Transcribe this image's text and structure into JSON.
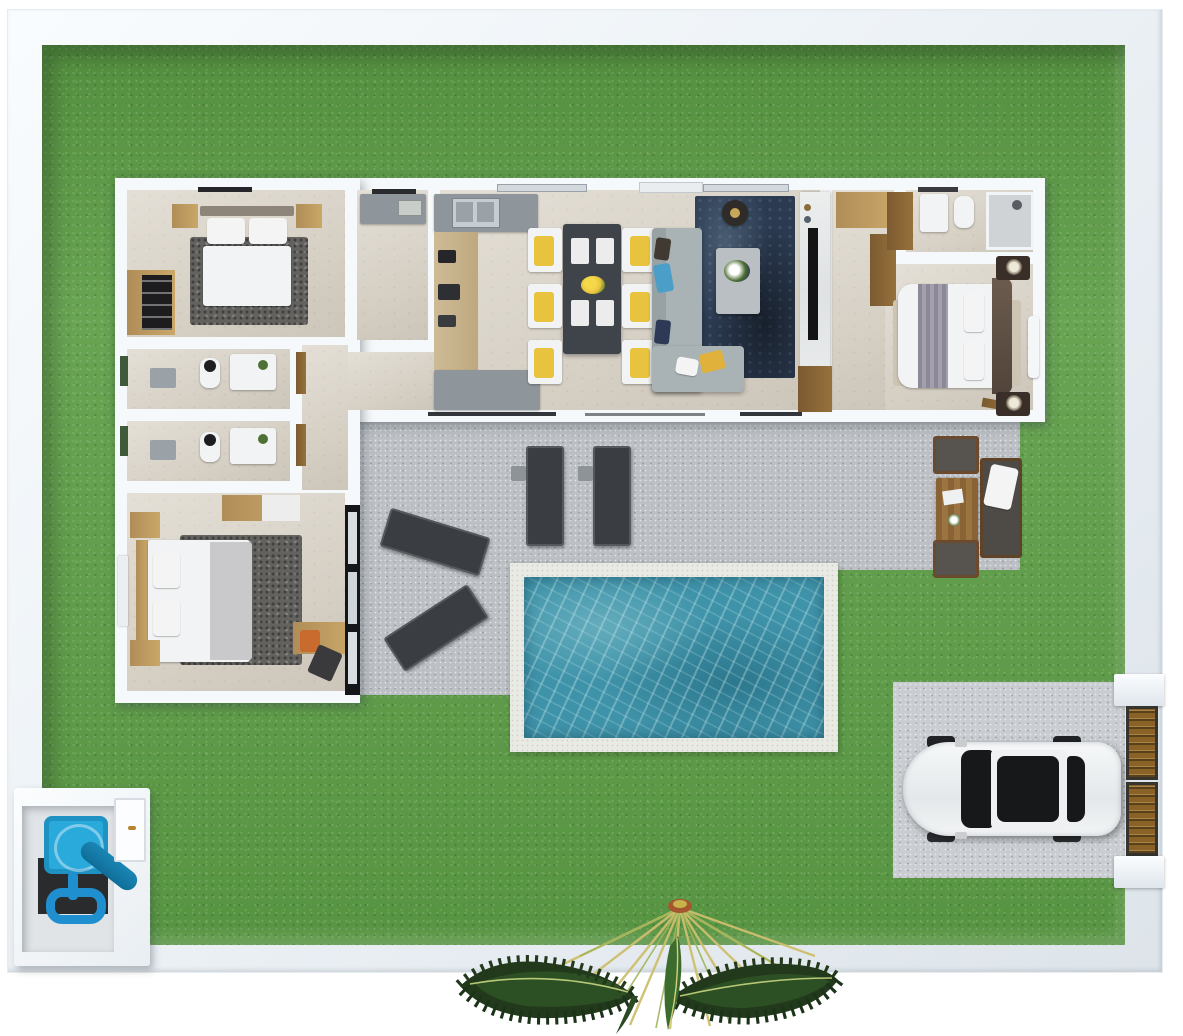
{
  "scene": {
    "title": "3D floor plan render — single-storey house with garden",
    "view": "top-down 3D render",
    "description": "House with three bedrooms, two bathrooms, ensuite, open kitchen-dining-living area, rear patio with sun loungers, outdoor lounge set, swimming pool, driveway with parked car, entrance gate, water-tank utility enclosure and a palm tree inside a walled lawn"
  },
  "palette": {
    "grass_green": "#5f9e48",
    "wall_white": "#f6f9fb",
    "floor_beige": "#d9d2c5",
    "patio_concrete": "#bcc0c4",
    "pool_water_teal": "#3f93a9",
    "pool_deck": "#e9eae3",
    "lounger_charcoal": "#3a3d41",
    "sofa_gray": "#a9b2b4",
    "rug_navy": "#2b3a50",
    "accent_yellow": "#e8c33f",
    "wood_light": "#b08d58",
    "wood_dark": "#8a6335",
    "gate_brown": "#8a6228",
    "tank_blue": "#2aa9db",
    "pipe_blue": "#1f8fd0",
    "car_white": "#f1f3f4",
    "car_glass_black": "#141518",
    "palm_frond_green": "#22391c",
    "palm_stem_yellow": "#cdbf6e"
  },
  "labels": {
    "garden": "Lawn / garden",
    "perimeter_wall": "Perimeter wall",
    "house": "House",
    "bedroom1": "Bedroom 1",
    "bedroom1_bed": "Double bed",
    "bedroom1_wardrobe": "Wardrobe",
    "laundry": "Laundry / storage room",
    "kitchen": "Kitchen",
    "kitchen_sink": "Kitchen sink",
    "dining": "Dining area",
    "dining_table": "Dining table for six",
    "dining_chair": "Dining chair with yellow cushion",
    "living": "Living room",
    "sofa": "L-shaped sofa",
    "coffee_table": "Coffee table",
    "tv_wall": "TV media wall",
    "hallway": "Entry hallway",
    "ensuite_bath": "Ensuite bathroom",
    "master_bedroom": "Master bedroom",
    "master_bed": "Double bed",
    "bathroom_a": "Bathroom 1",
    "bathroom_b": "Bathroom 2",
    "wing_hall": "Bedroom-wing hallway",
    "bedroom3": "Bedroom 3",
    "bedroom3_desk": "Desk",
    "patio": "Patio terrace",
    "sun_lounger": "Sun lounger",
    "lounge_set": "Outdoor lounge set",
    "pool": "Swimming pool",
    "driveway": "Driveway",
    "car": "Parked car",
    "entrance_gate": "Entrance gate",
    "utility_box": "Water-tank utility enclosure",
    "palm_tree": "Palm tree"
  }
}
